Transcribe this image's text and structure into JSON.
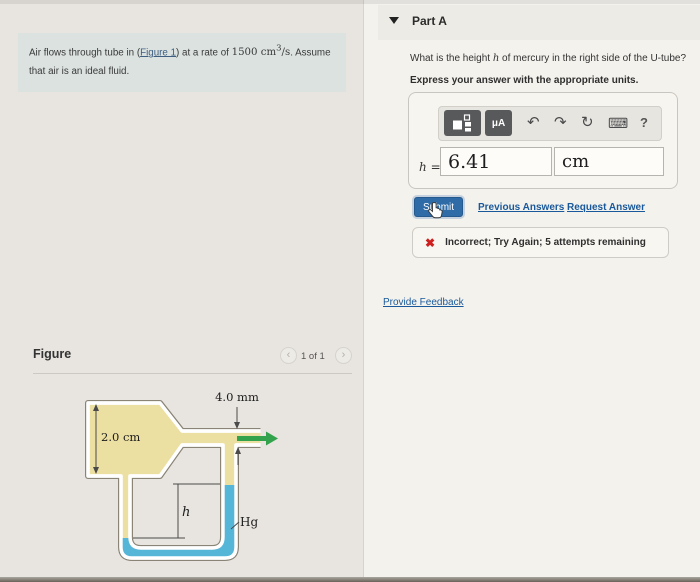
{
  "problem": {
    "text_before_link": "Air flows through tube in (",
    "figure_link": "Figure 1",
    "text_after_link": ") at a rate of ",
    "rate_base": "1500 cm",
    "rate_exponent": "3",
    "rate_unit_suffix": "/s",
    "text_line1_end": ". Assume",
    "text_line2": "that air is an ideal fluid."
  },
  "part_a": {
    "title": "Part A",
    "question_before_var": "What is the height ",
    "question_var": "h",
    "question_after_var": " of mercury in the right side of the U-tube?",
    "instruction": "Express your answer with the appropriate units.",
    "toolbar": {
      "units_button_label": "μA",
      "undo_icon": "↶",
      "redo_icon": "↷",
      "reset_icon": "↻",
      "keyboard_icon": "⌨",
      "help_label": "?"
    },
    "answer": {
      "variable": "h",
      "equals": "=",
      "value": "6.41",
      "units": "cm"
    },
    "submit_label": "Submit",
    "previous_answers_label": "Previous Answers",
    "request_answer_label": "Request Answer",
    "alert": {
      "icon": "✖",
      "message": "Incorrect; Try Again; 5 attempts remaining"
    },
    "provide_feedback_label": "Provide Feedback"
  },
  "figure_panel": {
    "title": "Figure",
    "page_indicator": "1 of 1",
    "prev_icon": "‹",
    "next_icon": "›",
    "diagram_labels": {
      "wide_diameter": "2.0 cm",
      "narrow_diameter": "4.0 mm",
      "height_var": "h",
      "mercury": "Hg"
    }
  },
  "colors": {
    "air_fill": "#ecdfa2",
    "mercury_fill": "#56b6d8",
    "tube_outline": "#8a8477",
    "flow_arrow": "#33a24d",
    "link_blue": "#19599b",
    "submit_blue": "#2f6ba6",
    "error_red": "#ce1f1f",
    "problem_box_bg": "#dbe2e0"
  }
}
